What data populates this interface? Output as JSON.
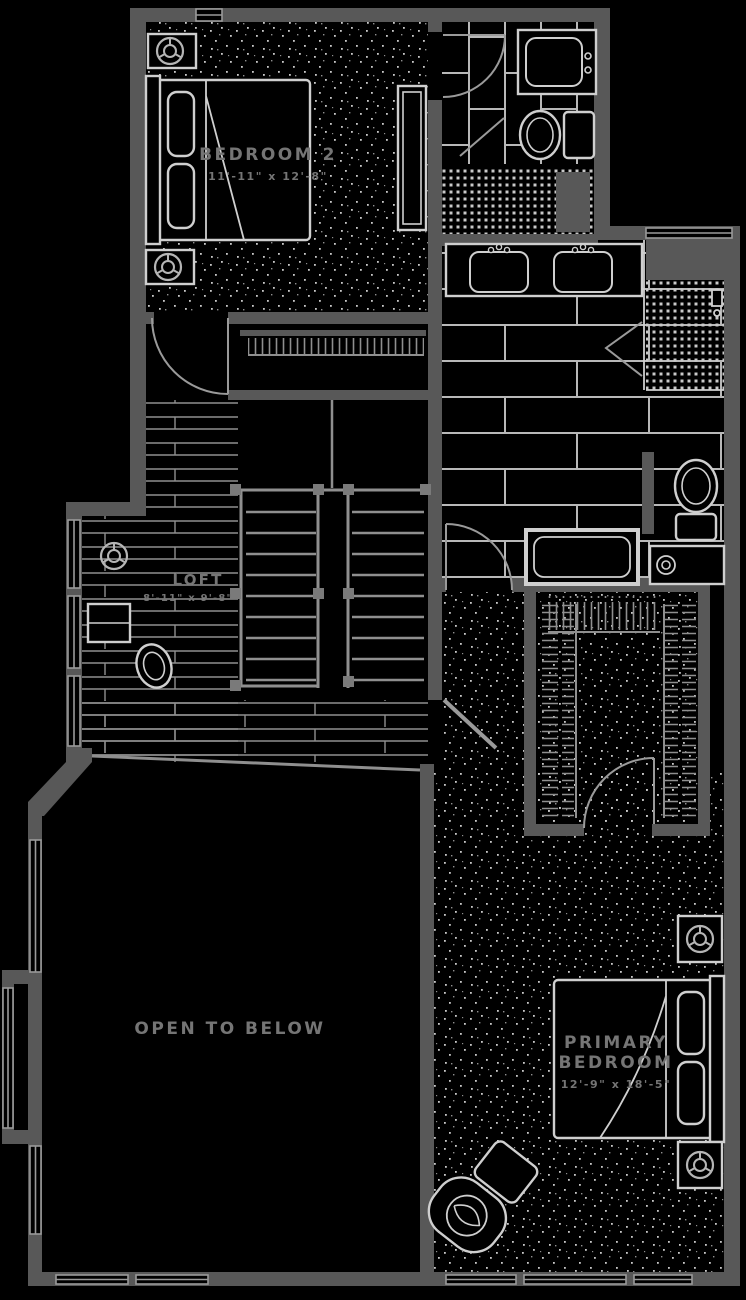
{
  "plan": {
    "floor_type": "residential-second-floor-plan",
    "rooms": {
      "bedroom2": {
        "label": "BEDROOM 2",
        "dimensions": "11'-11\" x 12'-8\""
      },
      "loft": {
        "label": "LOFT",
        "dimensions": "8'-11\" x 9'-8\""
      },
      "open_to_below": {
        "label": "OPEN TO BELOW"
      },
      "primary_bedroom": {
        "label_line1": "PRIMARY",
        "label_line2": "BEDROOM",
        "dimensions": "12'-9\" x 18'-5\""
      }
    },
    "symbols": {
      "ceiling_speaker": "circle-with-Y-spokes",
      "ceiling_fan": "circle-with-Y-spokes",
      "hanger_rod": "tick-marks-along-wall",
      "door": "quarter-arc-swing",
      "window": "double-line-in-wall"
    },
    "colors": {
      "background": "#000000",
      "wall": "#585858",
      "fixture_line": "#cfcfcf",
      "secondary_line": "#9a9a9a",
      "tile_line": "#b8b8b8",
      "texture_dot": "#c9c9c9",
      "text": "#757575"
    }
  }
}
